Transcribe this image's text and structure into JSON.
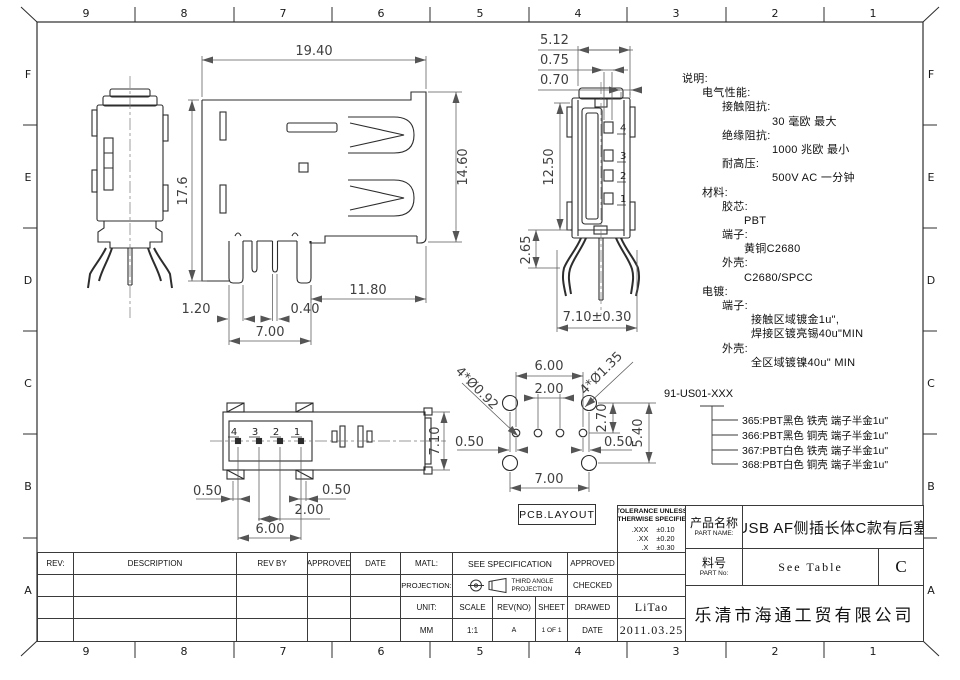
{
  "border": {
    "cols": [
      "9",
      "8",
      "7",
      "6",
      "5",
      "4",
      "3",
      "2",
      "1"
    ],
    "rows": [
      "F",
      "E",
      "D",
      "C",
      "B",
      "A"
    ]
  },
  "views": {
    "side": {
      "width": "19.40",
      "height": "17.6",
      "shell_height": "14.60",
      "pin_field": "11.80",
      "pin_width": "0.40",
      "leg_width": "1.20",
      "leg_span": "7.00"
    },
    "front": {
      "depth": "5.12",
      "contact_width": "0.75",
      "wall": "0.70",
      "socket_depth": "12.50",
      "base_height": "2.65",
      "leg_span": "7.10±0.30",
      "pins": [
        "4",
        "3",
        "2",
        "1"
      ]
    },
    "bottom": {
      "offset_left": "0.50",
      "offset_right": "0.50",
      "pitch": "2.00",
      "span": "6.00",
      "width": "7.10",
      "pins": [
        "4",
        "3",
        "2",
        "1"
      ]
    },
    "pcb": {
      "label": "PCB.LAYOUT",
      "span": "6.00",
      "pitch": "2.00",
      "row_offset": "2.70",
      "row_span": "5.40",
      "offset_left": "0.50",
      "offset_right": "0.50",
      "mount_span": "7.00",
      "small_holes": "4*Ø0.92",
      "large_holes": "4*Ø1.35"
    }
  },
  "notes": {
    "lines": [
      {
        "t": "说明:"
      },
      {
        "t": "电气性能:"
      },
      {
        "t": "接触阻抗:"
      },
      {
        "t": "30 毫欧 最大"
      },
      {
        "t": "绝缘阻抗:"
      },
      {
        "t": "1000 兆欧 最小"
      },
      {
        "t": "耐高压:"
      },
      {
        "t": "500V AC 一分钟"
      },
      {
        "t": "材料:"
      },
      {
        "t": "胶芯:"
      },
      {
        "t": "PBT"
      },
      {
        "t": "端子:"
      },
      {
        "t": "黄铜C2680"
      },
      {
        "t": "外壳:"
      },
      {
        "t": "C2680/SPCC"
      },
      {
        "t": "电镀:"
      },
      {
        "t": "端子:"
      },
      {
        "t": "接触区域镀金1u\","
      },
      {
        "t": "焊接区镀亮锡40u\"MIN"
      },
      {
        "t": "外壳:"
      },
      {
        "t": "全区域镀镍40u\" MIN"
      }
    ]
  },
  "part_numbers": {
    "base": "91-US01-XXX",
    "variants": [
      "365:PBT黑色 铁壳 端子半金1u\"",
      "366:PBT黑色 铜壳 端子半金1u\"",
      "367:PBT白色 铁壳 端子半金1u\"",
      "368:PBT白色 铜壳 端子半金1u\""
    ]
  },
  "title_block": {
    "rev_table": {
      "headers": [
        "REV:",
        "DESCRIPTION",
        "REV BY",
        "APPROVED",
        "DATE"
      ]
    },
    "matl": {
      "label": "MATL:",
      "value": "SEE  SPECIFICATION"
    },
    "projection": {
      "label": "PROJECTION:",
      "value_line1": "THIRD ANGLE",
      "value_line2": "PROJECTION"
    },
    "unit": {
      "label": "UNIT:",
      "value": "MM"
    },
    "scale": {
      "label": "SCALE",
      "value": "1:1"
    },
    "revno": {
      "label": "REV(NO)",
      "value": "A"
    },
    "sheet": {
      "label": "SHEET",
      "value": "1 OF 1"
    },
    "approved": {
      "label": "APPROVED",
      "value": ""
    },
    "checked": {
      "label": "CHECKED",
      "value": ""
    },
    "drawed": {
      "label": "DRAWED",
      "value": "LiTao"
    },
    "date": {
      "label": "DATE",
      "value": "2011.03.25"
    },
    "tolerance": {
      "line1": "TOLERANCE UNLESS",
      "line2": "OTHERWISE SPECIFIED",
      "rows": [
        {
          "k": ".XXX",
          "v": "±0.10"
        },
        {
          "k": ".XX",
          "v": "±0.20"
        },
        {
          "k": ".X",
          "v": "±0.30"
        },
        {
          "k": ".X°",
          "v": "±3°"
        }
      ]
    },
    "part_name": {
      "label_cn": "产品名称",
      "label_en": "PART NAME:",
      "value": "USB AF侧插长体C款有后塞"
    },
    "part_no": {
      "label_cn": "料号",
      "label_en": "PART No:",
      "value": "See Table",
      "rev": "C"
    },
    "company": "乐清市海通工贸有限公司"
  }
}
